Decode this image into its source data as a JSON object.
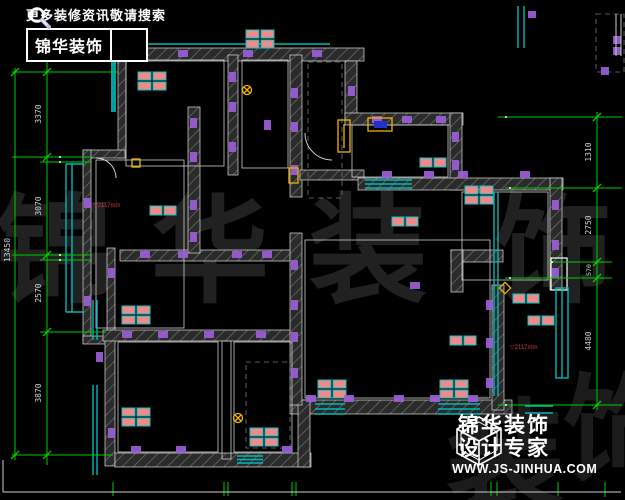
{
  "title": "residential-floor-plan-cad-drawing",
  "brand_top": {
    "slogan": "更多装修资讯敬请搜索",
    "name": "锦华装饰"
  },
  "brand_bottom": {
    "name": "锦华装饰",
    "tagline": "设计专家",
    "website": "WWW.JS-JINHUA.COM"
  },
  "watermark": {
    "row1": [
      "锦",
      "华",
      "装",
      "饰"
    ],
    "row2": [
      "装",
      "饰"
    ]
  },
  "dimensions": {
    "left": {
      "total": "13450",
      "segments": [
        "3370",
        "3070",
        "2570",
        "3870"
      ]
    },
    "right": {
      "segments": [
        "1310",
        "2750",
        "570",
        "4480"
      ]
    }
  },
  "annotations": {
    "left_room_level": "▽2117mm",
    "right_room_level": "▽2117mm"
  },
  "colors": {
    "background": "#000000",
    "walls": "#2e2e2e",
    "outline": "#ffffff",
    "window": "#00b8b8",
    "dimension_line": "#00cc00",
    "dimension_text": "#d0d0d0",
    "symbol_purple": "#9a5fd6",
    "furniture_red": "#f08a8a",
    "accent_yellow": "#f0b400",
    "annotation_red": "#cc3a3a",
    "watermark": "#212121"
  }
}
